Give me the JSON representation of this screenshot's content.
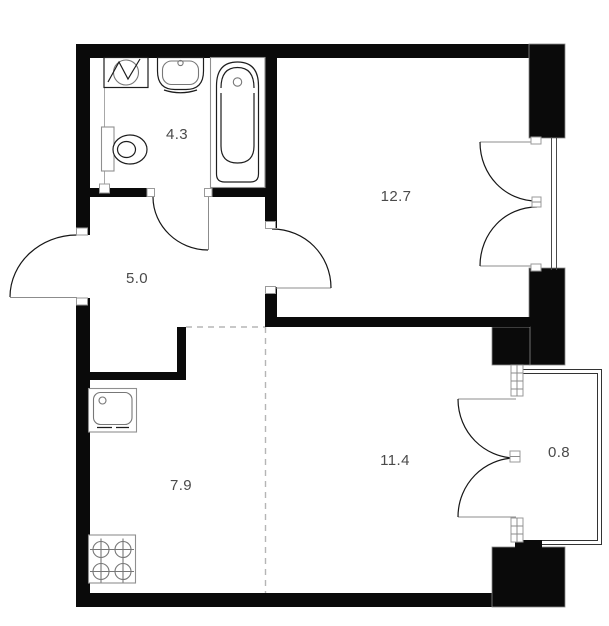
{
  "plan": {
    "type": "apartment-floor-plan",
    "background_color": "#ffffff",
    "wall_color": "#0a0a0a",
    "label_color": "#4a4a4a",
    "rooms": [
      {
        "name": "bathroom",
        "area": "4.3"
      },
      {
        "name": "bedroom",
        "area": "12.7"
      },
      {
        "name": "hallway",
        "area": "5.0"
      },
      {
        "name": "kitchen",
        "area": "7.9"
      },
      {
        "name": "living-room",
        "area": "11.4"
      },
      {
        "name": "balcony",
        "area": "0.8"
      }
    ],
    "fixtures": [
      "washing-machine",
      "bathroom-sink",
      "bathtub",
      "toilet",
      "kitchen-sink",
      "stove-4-burner"
    ],
    "openings": [
      "entrance-door",
      "bathroom-door",
      "bedroom-door",
      "bedroom-french-window",
      "balcony-french-door"
    ]
  }
}
